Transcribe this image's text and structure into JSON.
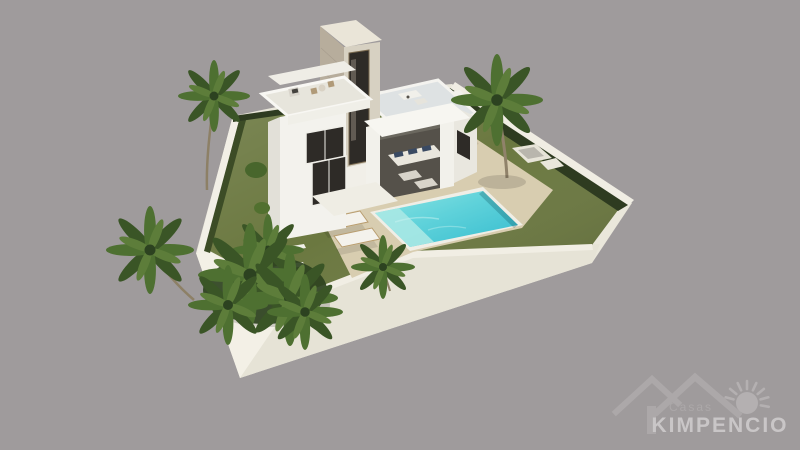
{
  "watermark": {
    "brand_top": "Casas",
    "brand_main": "KIMPENCIO",
    "icons": [
      "roof-icon",
      "sun-icon"
    ]
  },
  "scene": {
    "colors": {
      "background": "#9f9b9c",
      "plinth": "#eae7db",
      "plinth_front_left": "#f3f0e6",
      "plinth_front_right": "#e6e3d6",
      "lawn": "#6b7840",
      "hedge": "#2e3b20",
      "deck": "#d8cdb0",
      "pool_shallow": "#a8e8e4",
      "pool_light": "#7edde0",
      "pool_deep": "#3ec3d4",
      "villa_white": "#f3f2ed",
      "glass": "#2e2b27",
      "travertine": "#b7ad9c",
      "roof_terrace": "#dee2e3",
      "palm_green": "#4e7031",
      "logo_gray": "#aca8a9",
      "logo_text": "#c9c6c7"
    }
  }
}
